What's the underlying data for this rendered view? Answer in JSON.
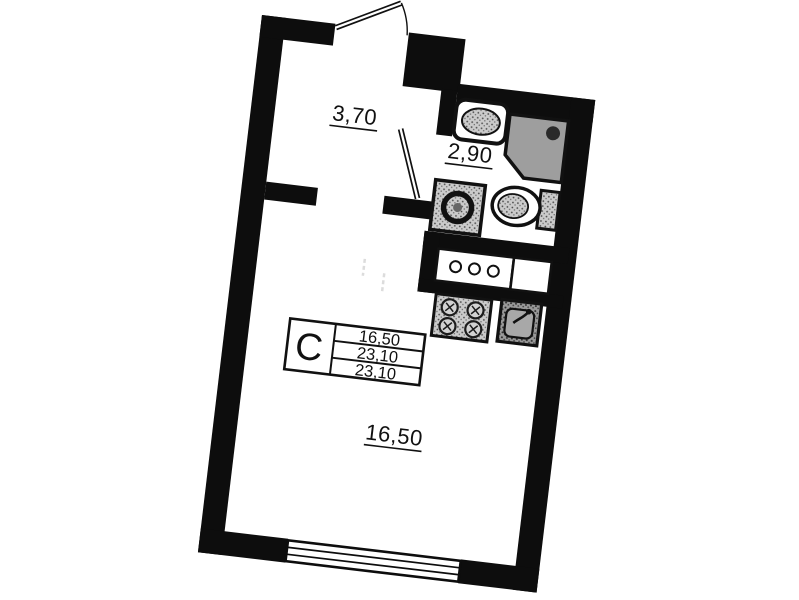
{
  "plan": {
    "kind": "studio-apartment-floor-plan",
    "legend": {
      "type_label": "С",
      "rows": [
        "16,50",
        "23,10",
        "23,10"
      ]
    },
    "rooms": {
      "hallway": {
        "area": "3,70"
      },
      "bathroom": {
        "area": "2,90"
      },
      "living": {
        "area": "16,50"
      }
    },
    "fixtures": [
      "entrance-door",
      "bathroom-door",
      "bathroom-sink",
      "shower-cabin",
      "toilet",
      "washing-machine",
      "kitchen-counter",
      "stove",
      "kitchen-sink",
      "window"
    ],
    "colors": {
      "wall": "#0d0d0d",
      "shower_fill": "#9e9e9e",
      "fixture_fill": "#cdcdcd",
      "background": "#ffffff"
    }
  }
}
